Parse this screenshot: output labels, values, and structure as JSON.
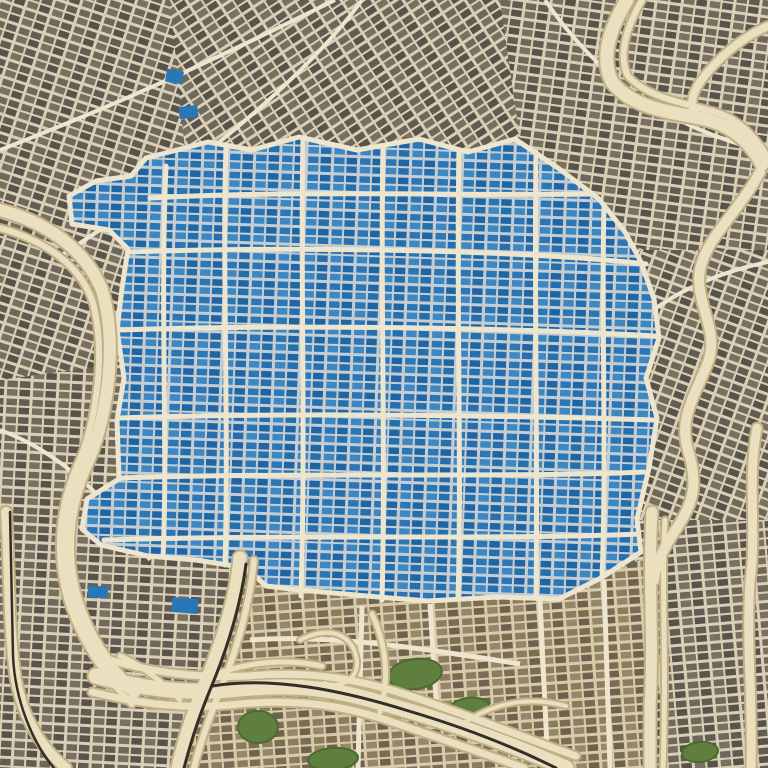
{
  "palette": {
    "street": "#d9cfb6",
    "street_major": "#ede5cd",
    "blue_street": "#c6cdd2",
    "tan_street": "#d8cba9",
    "highway_fill": "#eadfbe",
    "highway_edge": "#c0b086",
    "rail": "#332e27",
    "park": "#5f7f3e",
    "park_edge": "#4c6a30",
    "pond": "#2a77b8",
    "gray_blocks": [
      "#6e675c",
      "#625c52",
      "#78715f",
      "#57524a"
    ],
    "blue_blocks": [
      "#2a77b8",
      "#1f65a4",
      "#3d88c3",
      "#2470ae"
    ],
    "tan_blocks": [
      "#8b7b5f",
      "#7b6c52",
      "#97876a",
      "#6f6150"
    ]
  },
  "map": {
    "patterns": [
      {
        "id": "p_base",
        "kind": "gray",
        "rotate": -33
      },
      {
        "id": "p_g18",
        "kind": "gray",
        "rotate": 18
      },
      {
        "id": "p_g8",
        "kind": "gray",
        "rotate": 8
      },
      {
        "id": "p_g3",
        "kind": "gray",
        "rotate": 3
      },
      {
        "id": "p_gm5",
        "kind": "gray",
        "rotate": -5
      },
      {
        "id": "p_g20",
        "kind": "gray",
        "rotate": 20
      },
      {
        "id": "p_blue",
        "kind": "blue",
        "rotate": 2
      },
      {
        "id": "p_tan",
        "kind": "tan",
        "rotate": -4
      }
    ],
    "gray_patches": [
      {
        "pattern": "p_g18",
        "points": "0,0 170,0 190,200 150,360 0,380"
      },
      {
        "pattern": "p_g8",
        "points": "500,0 768,0 768,300 620,240 520,140"
      },
      {
        "pattern": "p_g20",
        "points": "640,250 768,250 768,520 640,520"
      },
      {
        "pattern": "p_g3",
        "points": "0,380 150,360 240,560 250,768 0,768"
      },
      {
        "pattern": "p_gm5",
        "points": "560,520 768,520 768,768 560,768"
      }
    ],
    "gray_arterials": [
      "M0,150 C140,96 250,42 335,0",
      "M60,256 C170,186 300,86 362,0",
      "M545,0 C598,78 668,128 768,152",
      "M768,262 C700,276 648,306 612,348",
      "M0,430 C60,452 110,500 150,560"
    ],
    "tan_zone": {
      "outline": "M236,578 L310,592 L436,602 L525,599 L604,577 L648,556 L655,768 L180,768 L206,672 Z",
      "majors": [
        "M362,606 L358,768",
        "M250,640 C330,634 420,648 520,664",
        "M430,604 L436,700",
        "M604,580 L610,768",
        "M540,600 L548,768"
      ]
    },
    "blue_district": {
      "outline": "M146,158 L208,142 L252,150 L299,137 L357,150 L419,139 L468,152 L515,139 L558,168 L599,199 L625,232 L641,262 L654,299 L659,338 L646,378 L657,418 L649,468 L637,519 L641,552 L601,578 L559,599 L498,597 L428,601 L378,597 L300,590 L266,586 L247,568 L196,560 L148,556 L101,545 L82,529 L87,499 L119,479 L117,420 L124,378 L117,330 L122,288 L128,249 L109,230 L72,224 L69,196 L96,181 L131,176 Z",
      "majors": [
        "M303,140 C300,260 306,430 301,596",
        "M383,146 C380,280 386,450 382,600",
        "M459,150 C456,300 462,460 458,599",
        "M536,152 C534,300 538,460 536,598",
        "M604,206 C601,320 607,450 602,578",
        "M226,148 C222,260 229,430 225,565",
        "M166,166 C160,300 168,450 163,557",
        "M150,198 C300,190 460,196 590,194",
        "M130,252 C300,246 520,250 646,264",
        "M120,330 C300,324 520,328 655,336",
        "M120,418 C300,412 520,416 654,420",
        "M121,478 C300,472 520,478 644,472",
        "M104,540 C300,534 500,540 639,534"
      ]
    },
    "ponds": [
      {
        "x": 166,
        "y": 70,
        "w": 17,
        "h": 13,
        "r": 10
      },
      {
        "x": 179,
        "y": 106,
        "w": 19,
        "h": 12,
        "r": -8
      },
      {
        "x": 172,
        "y": 598,
        "w": 26,
        "h": 15,
        "r": 5
      },
      {
        "x": 88,
        "y": 586,
        "w": 20,
        "h": 12,
        "r": 3
      }
    ],
    "parks": [
      {
        "cx": 415,
        "cy": 674,
        "rx": 27,
        "ry": 15,
        "rot": -8
      },
      {
        "cx": 468,
        "cy": 711,
        "rx": 22,
        "ry": 13,
        "rot": -12
      },
      {
        "cx": 258,
        "cy": 727,
        "rx": 20,
        "ry": 16,
        "rot": 0
      },
      {
        "cx": 333,
        "cy": 759,
        "rx": 25,
        "ry": 11,
        "rot": -4
      },
      {
        "cx": 700,
        "cy": 752,
        "rx": 18,
        "ry": 10,
        "rot": -6
      }
    ],
    "highways": [
      {
        "d": "M0,210 C45,222 85,248 102,290 C118,345 108,420 84,470 C66,512 62,560 78,606 C90,640 108,668 134,692",
        "w": 12
      },
      {
        "d": "M0,228 C42,240 78,262 92,300 C106,348 98,420 76,468 C58,510 54,560 70,608 C84,646 106,678 132,704",
        "w": 6
      },
      {
        "d": "M240,558 C236,600 222,642 206,682 C192,716 184,740 178,768",
        "w": 13
      },
      {
        "d": "M254,560 C250,602 238,646 222,686 C208,720 200,744 194,768",
        "w": 6
      },
      {
        "d": "M96,676 C140,688 180,694 230,690 C300,682 340,690 392,706 C450,722 510,744 566,768",
        "w": 15
      },
      {
        "d": "M110,660 C160,674 200,678 248,676 C310,670 360,680 404,694 C460,712 520,736 576,756",
        "w": 7
      },
      {
        "d": "M92,692 C140,704 186,710 240,704 C306,698 352,708 392,722 C446,740 490,756 524,768",
        "w": 7
      },
      {
        "d": "M6,512 C10,570 8,630 16,680 C24,722 44,750 66,768",
        "w": 10
      },
      {
        "d": "M627,0 C610,28 600,58 612,82 C632,108 670,112 700,118 C732,124 750,142 762,164",
        "w": 13
      },
      {
        "d": "M642,0 C626,28 618,56 628,76 C646,96 678,102 708,110 C736,116 754,134 768,158",
        "w": 6
      },
      {
        "d": "M768,26 C740,38 716,60 700,82 C692,94 690,104 695,114",
        "w": 8
      },
      {
        "d": "M760,172 C740,210 706,238 700,270 C694,302 720,330 708,362 C696,394 678,418 688,450 C698,482 694,502 678,526 C664,548 656,562 654,580",
        "w": 10
      },
      {
        "d": "M652,512 C648,575 654,645 650,705 L650,768",
        "w": 11
      },
      {
        "d": "M665,520 C661,585 667,655 663,768",
        "w": 5
      },
      {
        "d": "M757,428 C747,480 757,532 750,582 C746,642 753,702 751,768",
        "w": 9
      },
      {
        "d": "M206,678 C244,662 284,658 322,666",
        "w": 5
      },
      {
        "d": "M180,700 C160,680 140,664 120,656",
        "w": 5
      },
      {
        "d": "M380,712 C390,678 386,644 372,614",
        "w": 5
      },
      {
        "d": "M300,640 C332,624 354,636 357,661 C358,679 342,689 324,683",
        "w": 4
      },
      {
        "d": "M460,726 C492,702 530,696 566,706",
        "w": 4
      }
    ],
    "rails": [
      {
        "d": "M246,564 C240,610 226,652 210,690 C196,724 190,746 184,768",
        "w": 3
      },
      {
        "d": "M212,686 C272,676 342,690 412,712 C472,730 520,750 556,768",
        "w": 3
      },
      {
        "d": "M10,512 L13,656 C15,700 32,742 54,768",
        "w": 2.5
      }
    ]
  }
}
